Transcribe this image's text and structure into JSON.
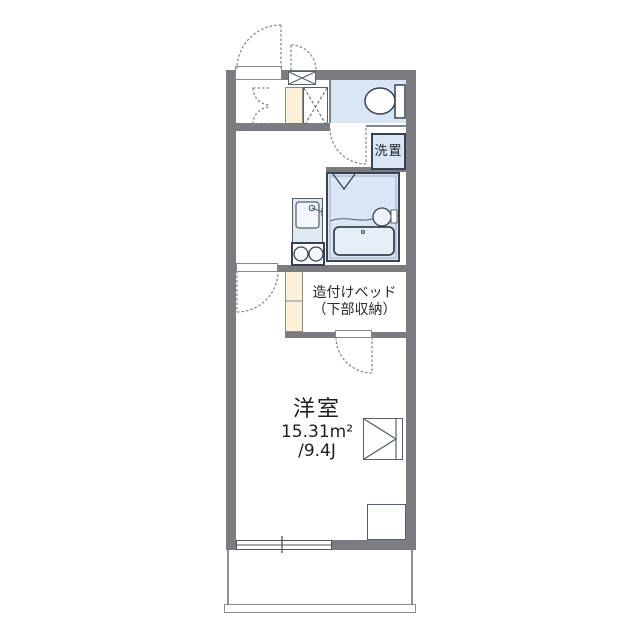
{
  "floorplan": {
    "labels": {
      "laundry": "洗置",
      "bed_line1": "造付けベッド",
      "bed_line2": "（下部収納）",
      "room_name": "洋室",
      "room_area": "15.31m²",
      "room_tatami": "/9.4J"
    },
    "icons": {
      "toilet": "toilet-top-view",
      "bathtub": "bathtub-top-view",
      "washbasin": "round-basin",
      "kitchen_sink": "sink-with-faucet",
      "stove": "two-burner-stove",
      "meter_box": "x-box",
      "pipe_space": "x-box-dashed",
      "hatch": "triangle-in-square",
      "doors": "quarter-circle-swing"
    },
    "colors": {
      "wall": "#7b7b80",
      "water_room_fill": "#d9e6f5",
      "closet_fill": "#fbf1d9",
      "fixture_line": "#3a4250",
      "door_swing_line": "#8a8a8a",
      "background": "#ffffff"
    }
  }
}
